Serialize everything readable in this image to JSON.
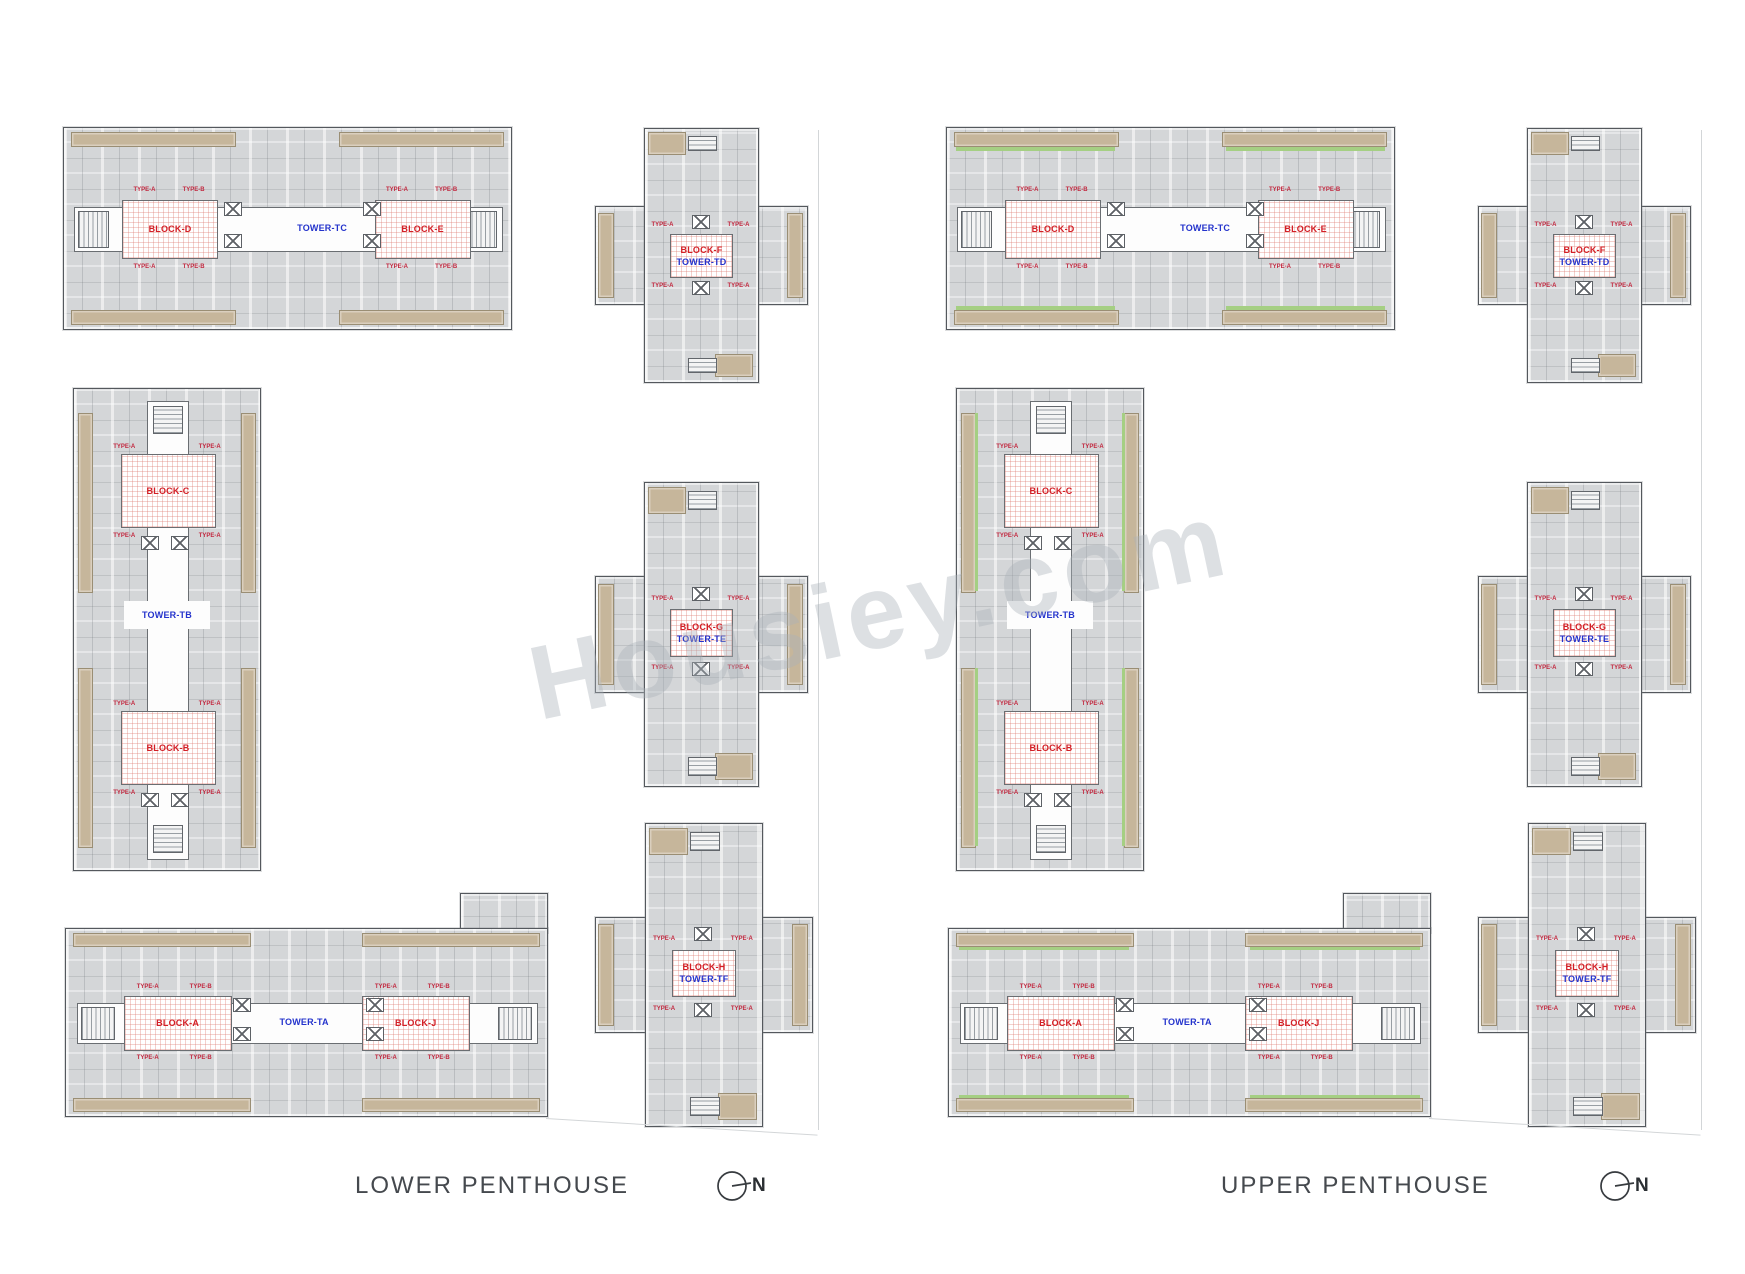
{
  "watermark": {
    "text": "Housiey.com"
  },
  "plans": [
    {
      "title": "LOWER PENTHOUSE",
      "north_label": "N",
      "top_building": {
        "block_left": "BLOCK-D",
        "tower": "TOWER-TC",
        "block_right": "BLOCK-E"
      },
      "side_building": {
        "block_top": "BLOCK-C",
        "tower": "TOWER-TB",
        "block_bottom": "BLOCK-B"
      },
      "bottom_building": {
        "block_left": "BLOCK-A",
        "tower": "TOWER-TA",
        "block_right": "BLOCK-J"
      },
      "corner_towers": [
        {
          "block": "BLOCK-F",
          "tower": "TOWER-TD"
        },
        {
          "block": "BLOCK-G",
          "tower": "TOWER-TE"
        },
        {
          "block": "BLOCK-H",
          "tower": "TOWER-TF"
        }
      ]
    },
    {
      "title": "UPPER PENTHOUSE",
      "north_label": "N",
      "top_building": {
        "block_left": "BLOCK-D",
        "tower": "TOWER-TC",
        "block_right": "BLOCK-E"
      },
      "side_building": {
        "block_top": "BLOCK-C",
        "tower": "TOWER-TB",
        "block_bottom": "BLOCK-B"
      },
      "bottom_building": {
        "block_left": "BLOCK-A",
        "tower": "TOWER-TA",
        "block_right": "BLOCK-J"
      },
      "corner_towers": [
        {
          "block": "BLOCK-F",
          "tower": "TOWER-TD"
        },
        {
          "block": "BLOCK-G",
          "tower": "TOWER-TE"
        },
        {
          "block": "BLOCK-H",
          "tower": "TOWER-TF"
        }
      ]
    }
  ],
  "unit_labels": {
    "type_a": "TYPE-A",
    "type_b": "TYPE-B"
  },
  "colors": {
    "block_label": "#d31f26",
    "tower_label": "#2433cc",
    "building_fill": "#d4d6d8",
    "balcony": "#c6b69b",
    "green_accent": "#a5cf83",
    "hatch_grid": "#dd7a70"
  }
}
